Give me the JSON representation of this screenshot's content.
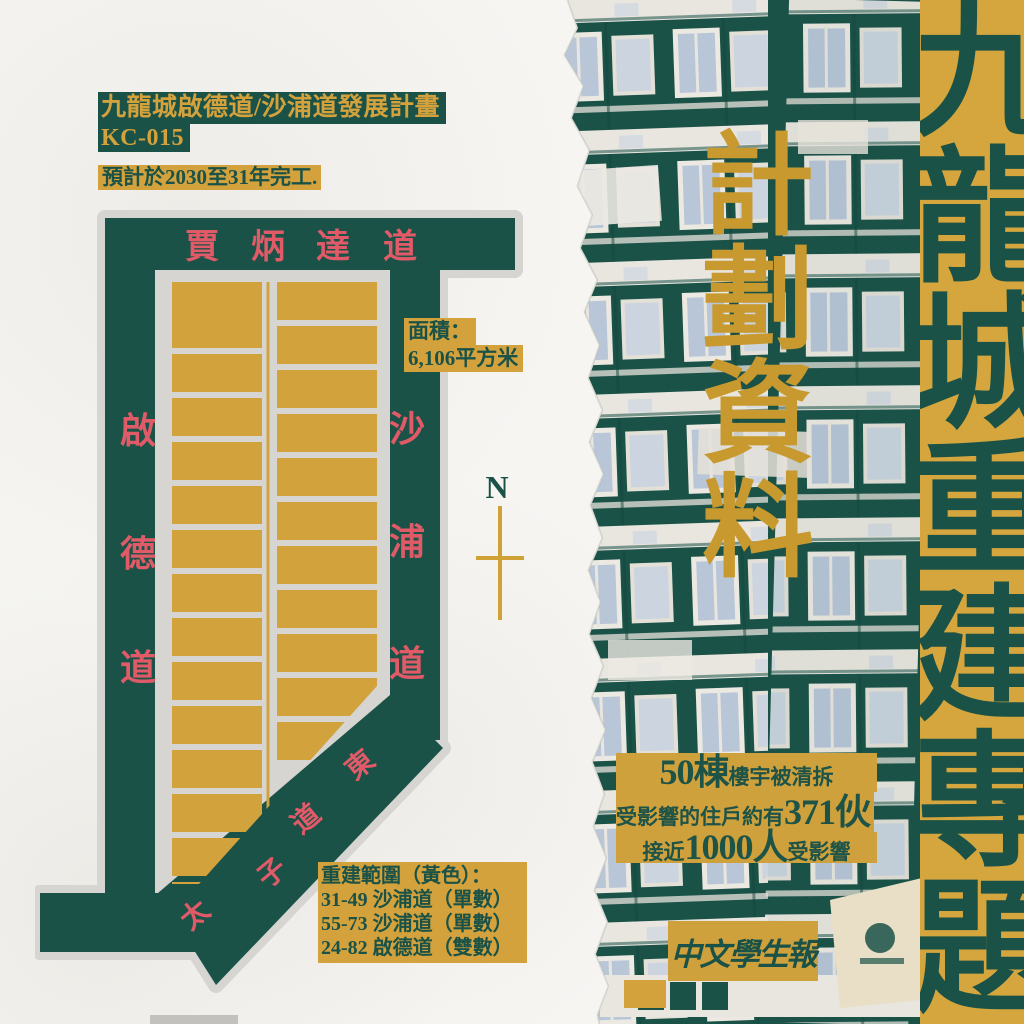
{
  "header": {
    "title": "九龍城啟德道/沙浦道發展計畫",
    "project_code": "KC-015",
    "completion_note": "預計於2030至31年完工."
  },
  "map": {
    "streets": {
      "top": [
        "賈",
        "炳",
        "達",
        "道"
      ],
      "left": [
        "啟",
        "德",
        "道"
      ],
      "right": [
        "沙",
        "浦",
        "道"
      ],
      "diagonal": [
        "太",
        "子",
        "道",
        "東"
      ]
    },
    "area_label": {
      "line1": "面積：",
      "line2": "6,106平方米"
    },
    "compass": {
      "label": "N"
    },
    "legend": {
      "heading": "重建範圍（黃色）：",
      "items": [
        "31-49 沙浦道（單數）",
        "55-73 沙浦道（單數）",
        "24-82 啟德道（雙數）"
      ]
    }
  },
  "photo_overlay": {
    "vertical_title": "計劃資料"
  },
  "stats": {
    "line1_big": "50棟",
    "line1_rest": "樓宇被清拆",
    "line2_lead": "受影響的住戶約有",
    "line2_big": "371伙",
    "line3_lead": "接近",
    "line3_big": "1000人",
    "line3_tail": "受影響"
  },
  "logo": {
    "text": "中文學生報"
  },
  "banner": {
    "vertical_title": "九龍城重建專題"
  },
  "colors": {
    "dark_green": "#1B5248",
    "gold": "#D3A23C",
    "street_name_red": "#E15A68",
    "paper": "#F6F5F2",
    "map_gray": "#D6D5D1",
    "window_blue": "#B8C6D8"
  }
}
